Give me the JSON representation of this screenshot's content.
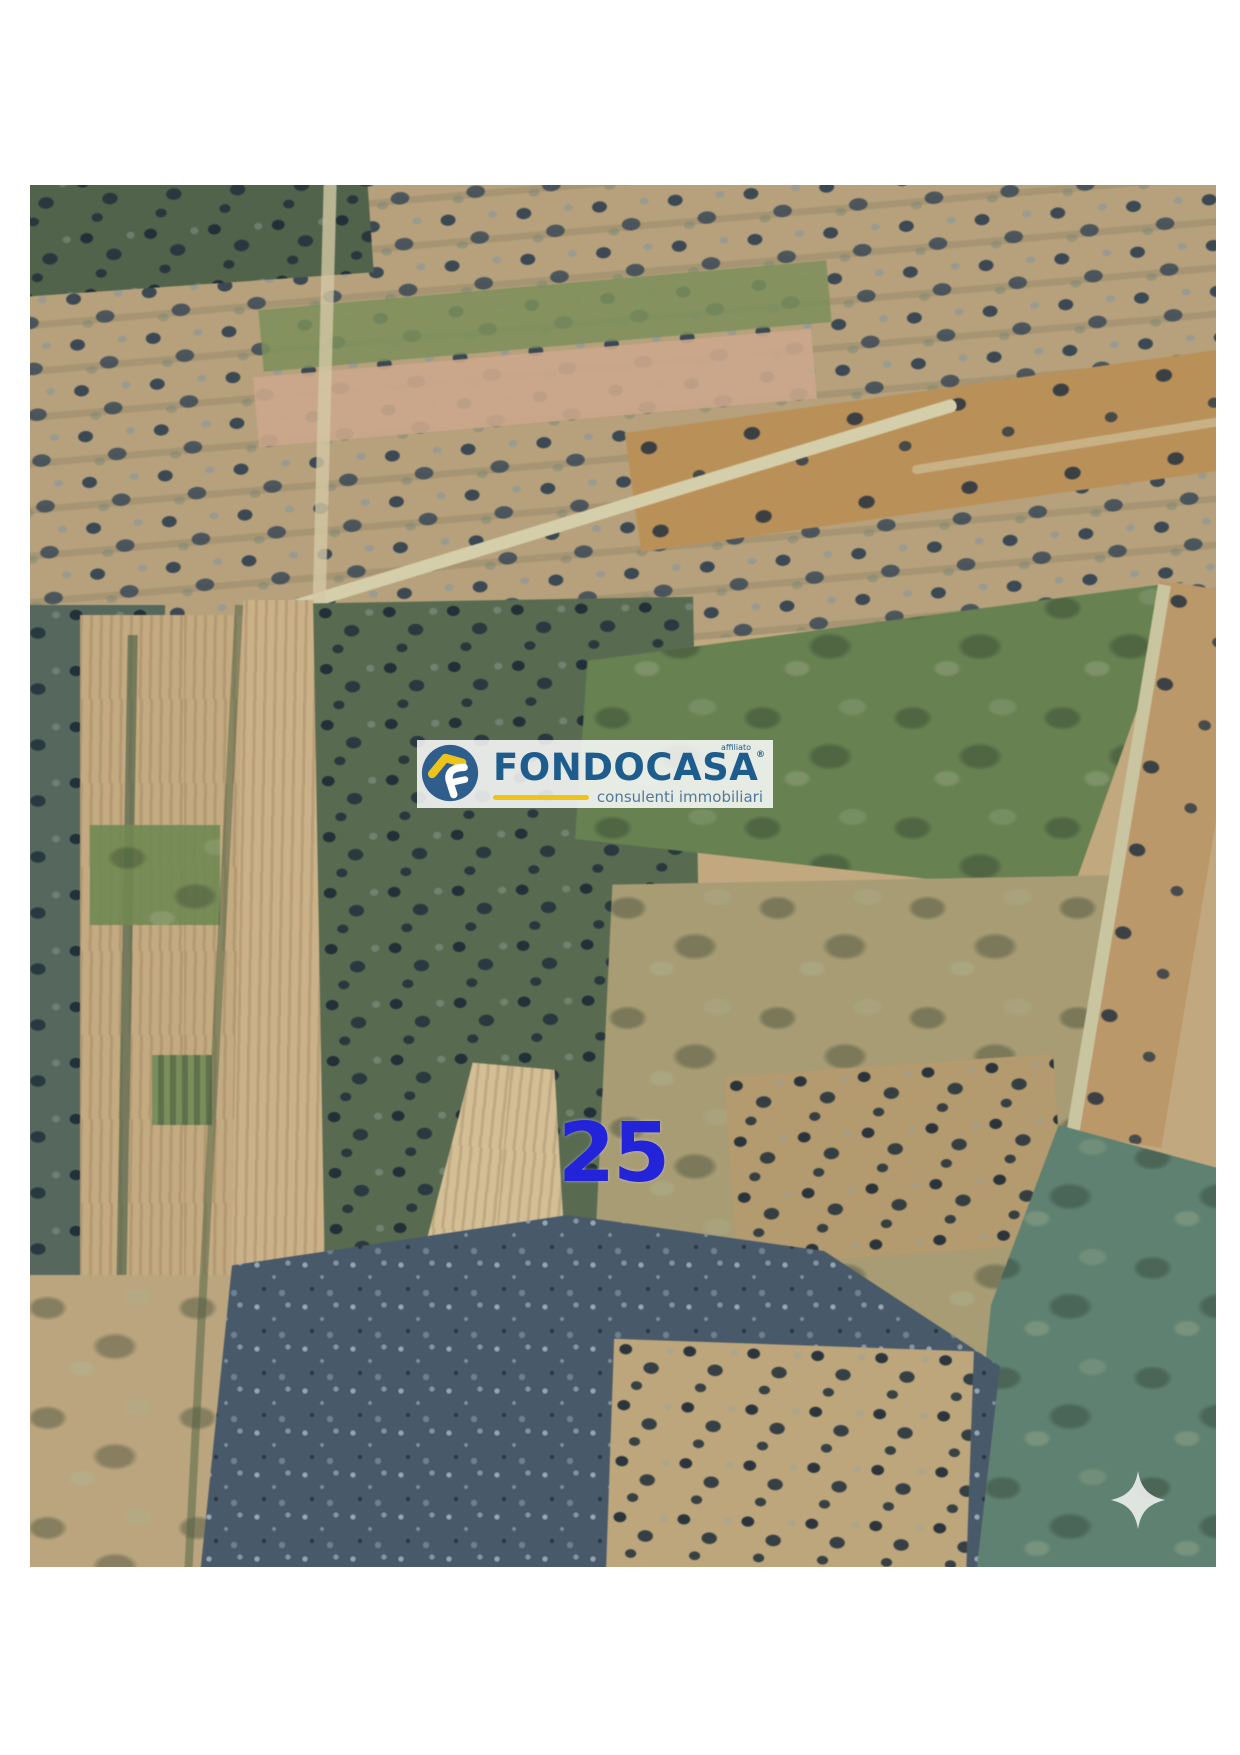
{
  "window": {
    "background_color": "#ffffff"
  },
  "photo": {
    "kind": "aerial-satellite-view",
    "subject": "farmland parcels with olive groves, plowed fields and country roads",
    "parcel_marker": {
      "label": "25",
      "color": "#2323d9"
    },
    "sparkle_icon_color": "#e9ede9"
  },
  "watermark": {
    "affiliate_label": "affiliato",
    "brand": "FONDOCASA",
    "registered_mark": "®",
    "tagline": "consulenti immobiliari",
    "colors": {
      "panel": "rgba(255,255,255,0.84)",
      "brand_blue": "#1e5c8e",
      "badge_blue": "#2f5d8c",
      "accent_yellow": "#eec41b",
      "tagline_blue": "#53789c"
    }
  },
  "cssvars": {
    "panel-white": "rgba(255,255,255,0.84)",
    "brand-blue": "#1e5c8e",
    "badge-blue": "#2f5d8c",
    "accent-yellow": "#eec41b",
    "tagline-blue": "#53789c",
    "parcel-blue": "#2323d9",
    "sparkle-white": "#e9ede9"
  }
}
